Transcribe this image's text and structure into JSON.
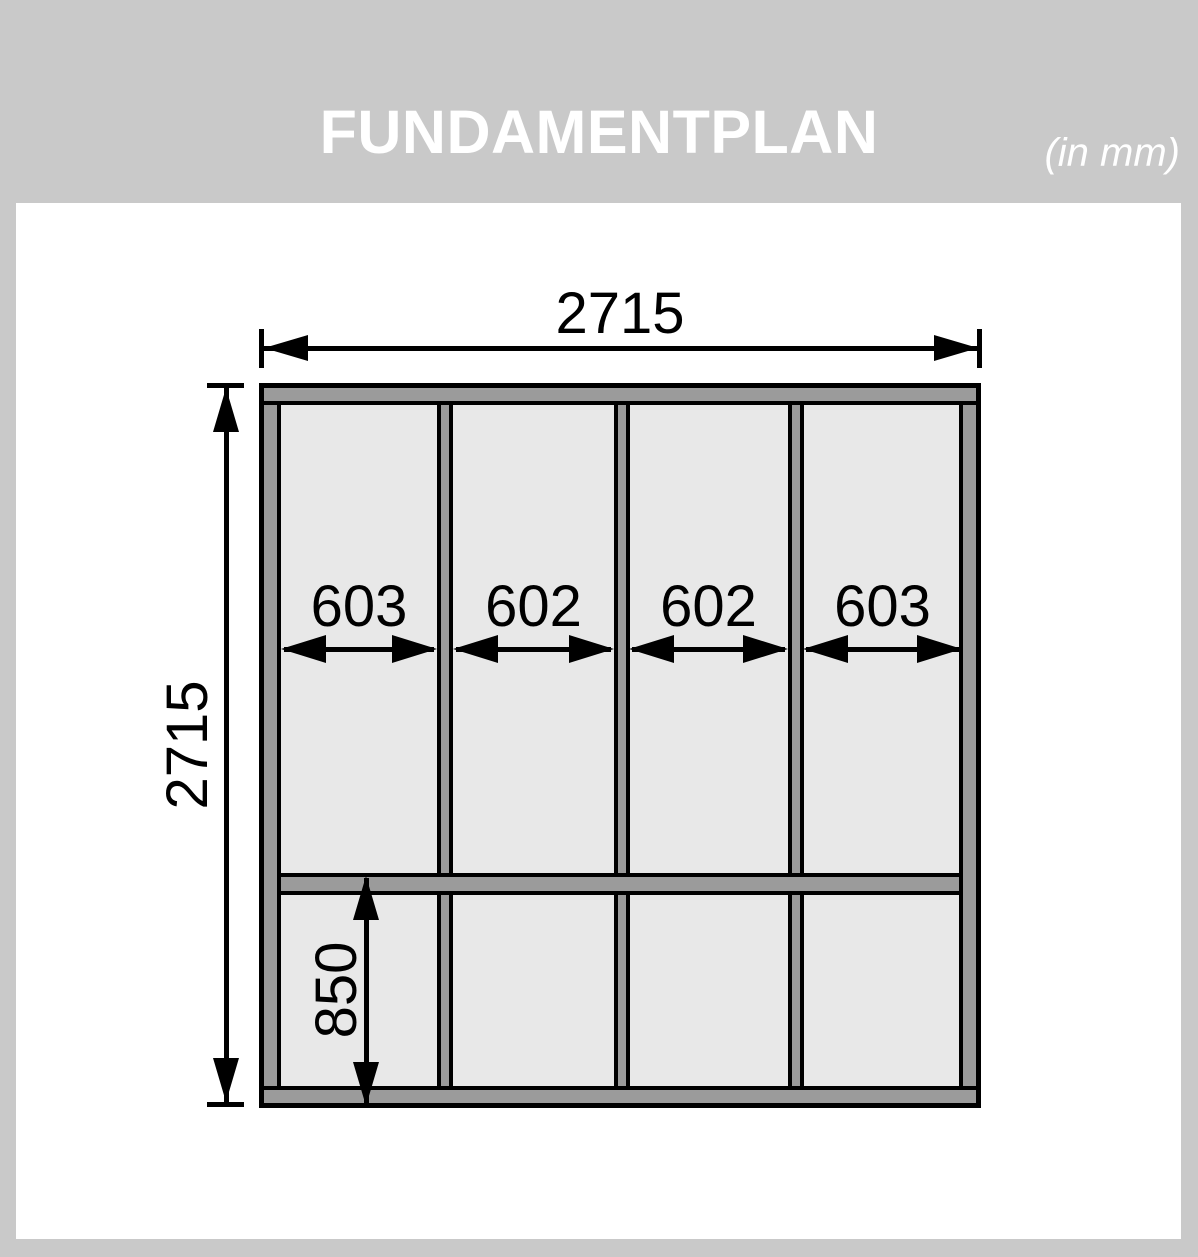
{
  "header": {
    "title": "FUNDAMENTPLAN",
    "unit_note": "(in mm)"
  },
  "diagram": {
    "overall_width_mm": "2715",
    "overall_height_mm": "2715",
    "bays": [
      {
        "label": "603"
      },
      {
        "label": "602"
      },
      {
        "label": "602"
      },
      {
        "label": "603"
      }
    ],
    "bottom_section_mm": "850"
  },
  "colors": {
    "background": "#c9c9c9",
    "panel": "#ffffff",
    "beam": "#9b9b9b",
    "deck": "#e8e8e8",
    "line": "#000000",
    "title_text": "#ffffff"
  }
}
